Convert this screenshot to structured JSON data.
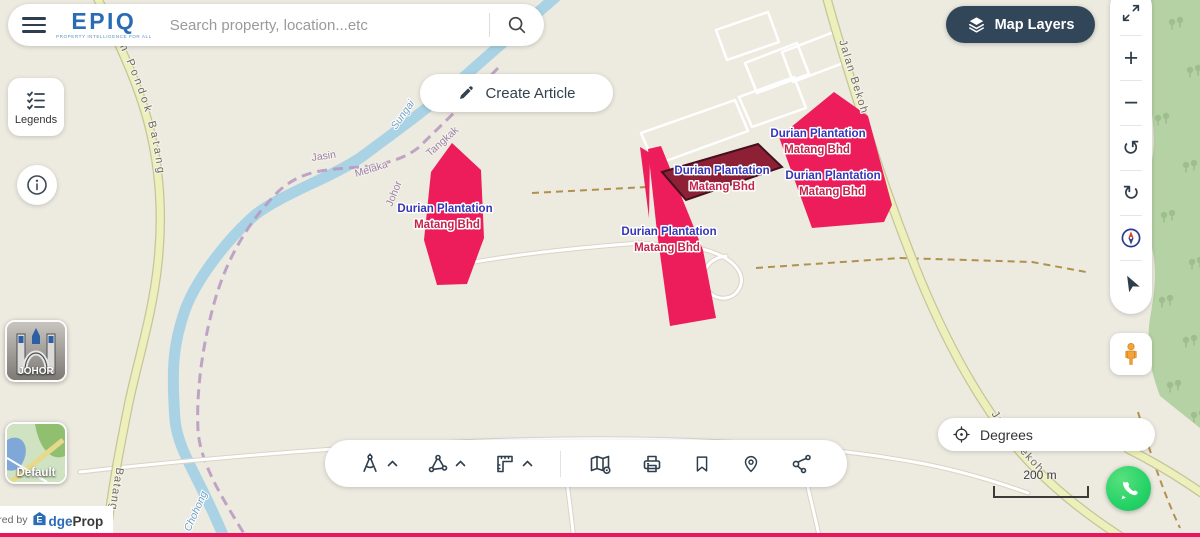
{
  "app": {
    "logo": "EPIQ",
    "tagline": "PROPERTY INTELLIGENCE FOR ALL",
    "powered_by": "Powered by",
    "brand_house": "E",
    "brand_mid": "dge",
    "brand_tail": "Prop"
  },
  "search": {
    "placeholder": "Search property, location...etc"
  },
  "actions": {
    "create_article": "Create Article",
    "map_layers": "Map Layers",
    "legends": "Legends",
    "degrees": "Degrees"
  },
  "tiles": {
    "region": "JOHOR",
    "style": "Default"
  },
  "scale": {
    "label": "200 m"
  },
  "icons": {
    "plus": "+",
    "minus": "−",
    "rotate_ccw": "↺",
    "rotate_cw": "↻"
  },
  "map": {
    "parcel_label": {
      "title": "Durian Plantation",
      "subtitle": "Matang Bhd"
    },
    "road_labels": {
      "pondok_batang": "Jalan Pondok Batang",
      "bekoh": "Jalan Bekoh",
      "batang": "Batang"
    },
    "water_labels": {
      "sungai": "Sungai",
      "chohong": "Chohong"
    },
    "boundary_labels": {
      "district_left": "Jasin",
      "state_left": "Melaka",
      "state_right": "Johor",
      "district_right": "Tangkak"
    },
    "colors": {
      "parcel": "#ED1C5B",
      "parcel_selected": "#8E2036",
      "label_title": "#3535B8",
      "label_subtitle": "#C3244A",
      "forest": "#B5D2A4",
      "road_yellow": "#EDF0BA",
      "water": "#A9D3E4",
      "accent_dark": "#32465A",
      "whatsapp": "#25D366"
    }
  }
}
